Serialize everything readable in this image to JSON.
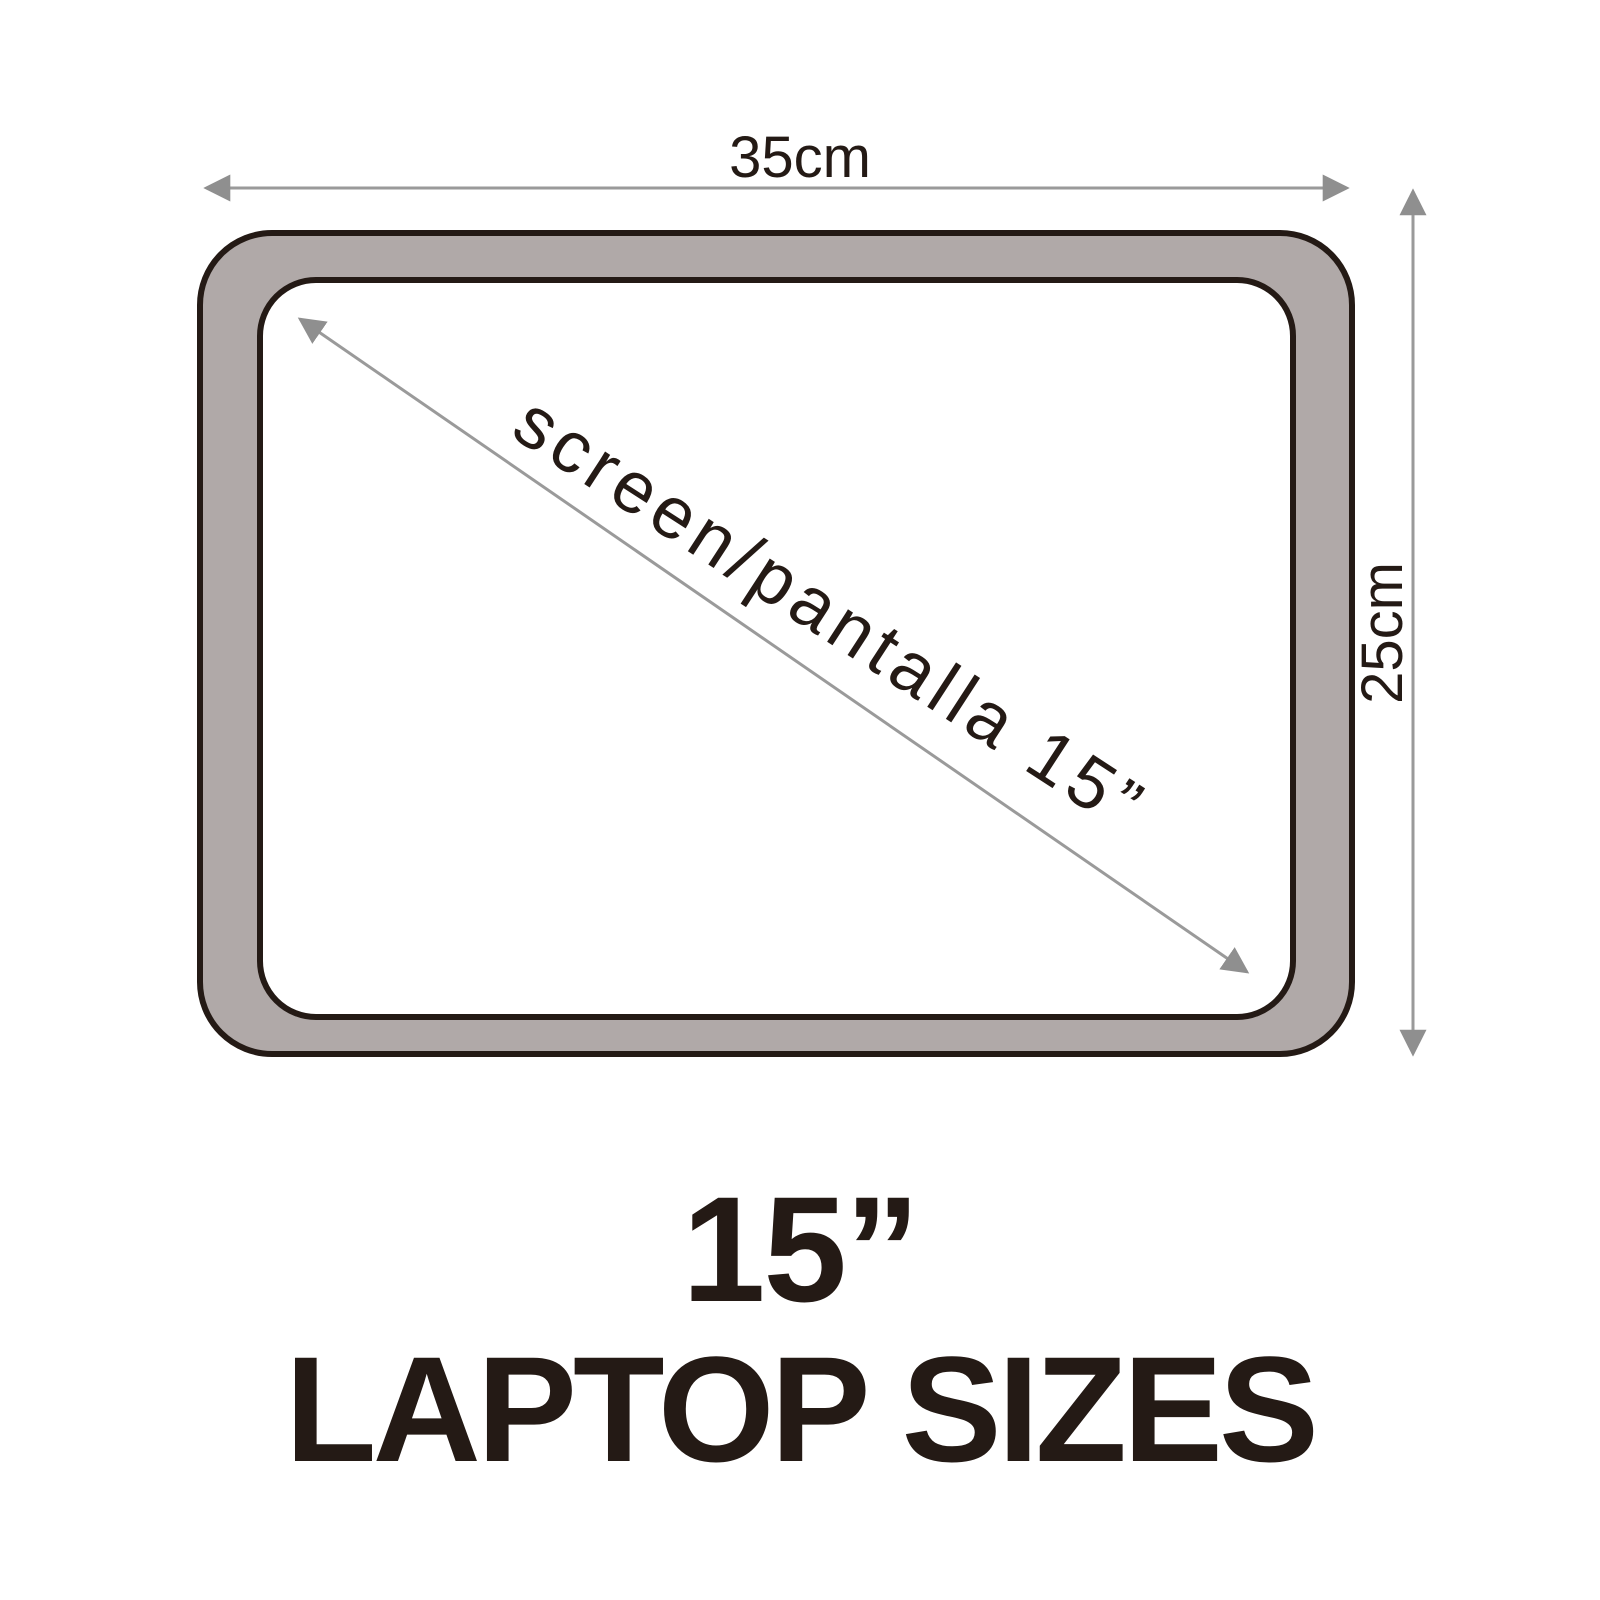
{
  "diagram": {
    "width_label": "35cm",
    "height_label": "25cm",
    "diagonal_label": "screen/pantalla 15”",
    "size_heading": "15”",
    "caption_heading": "LAPTOP SIZES"
  },
  "colors": {
    "background": "#ffffff",
    "frame_fill": "#b0a9a8",
    "screen_fill": "#ffffff",
    "outline": "#241a15",
    "arrow": "#9a9a9a",
    "arrowhead": "#8f8f8f",
    "text": "#241a15"
  }
}
